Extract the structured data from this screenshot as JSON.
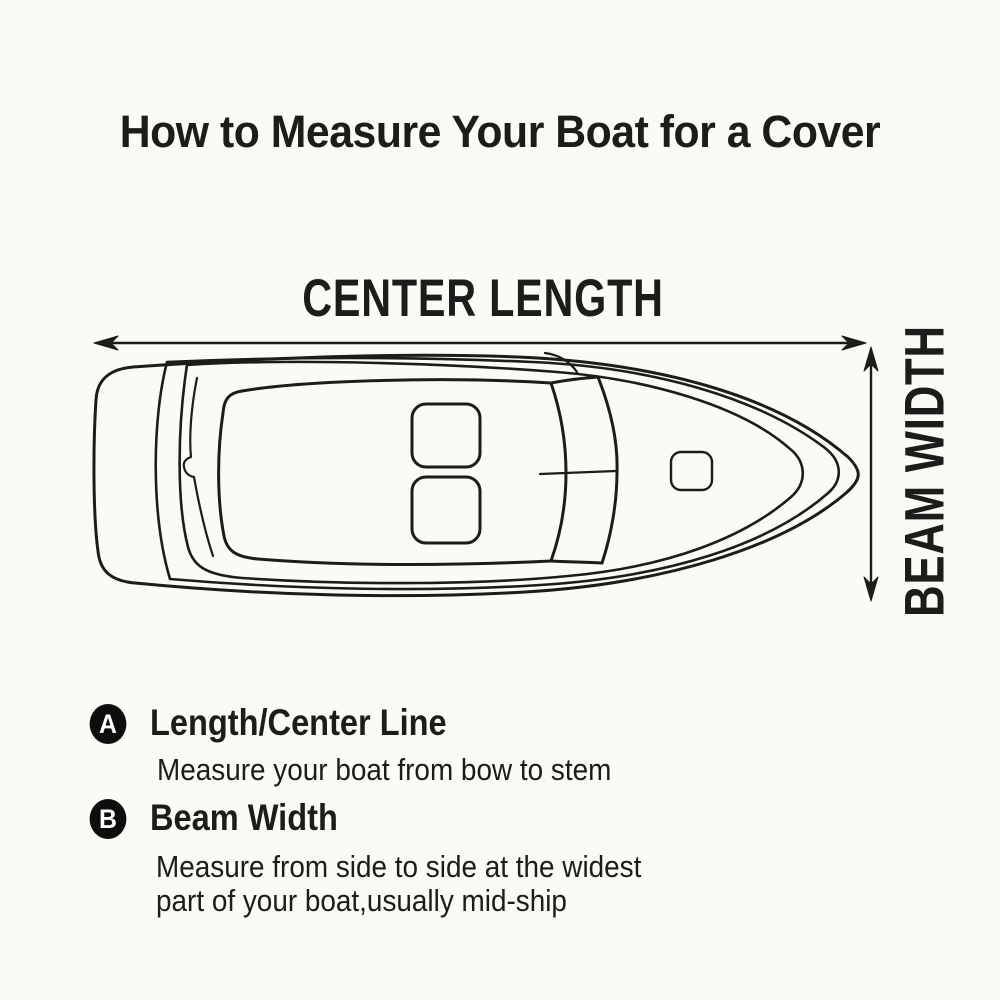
{
  "title": "How to Measure Your Boat for a Cover",
  "diagram": {
    "length_label": "CENTER LENGTH",
    "width_label": "BEAM WIDTH",
    "drawing": "top-view line drawing of a boat, bow pointing right, stern with swim platform at left, walk-through windshield, two cockpit seats, bow hatch",
    "arrows": [
      "horizontal double-headed arrow spanning hull length",
      "vertical double-headed arrow spanning hull width at bow side"
    ]
  },
  "legend": {
    "items": [
      {
        "badge": "A",
        "heading": "Length/Center Line",
        "line1": "Measure your boat from bow to stem"
      },
      {
        "badge": "B",
        "heading": "Beam Width",
        "line1": "Measure from side to side at the widest",
        "line2": "part of your boat,usually mid-ship"
      }
    ]
  },
  "colors": {
    "ink": "#1d1c1a",
    "paper": "#fbfaf6",
    "badge_bg": "#0e0d0c",
    "badge_text": "#ffffff"
  }
}
